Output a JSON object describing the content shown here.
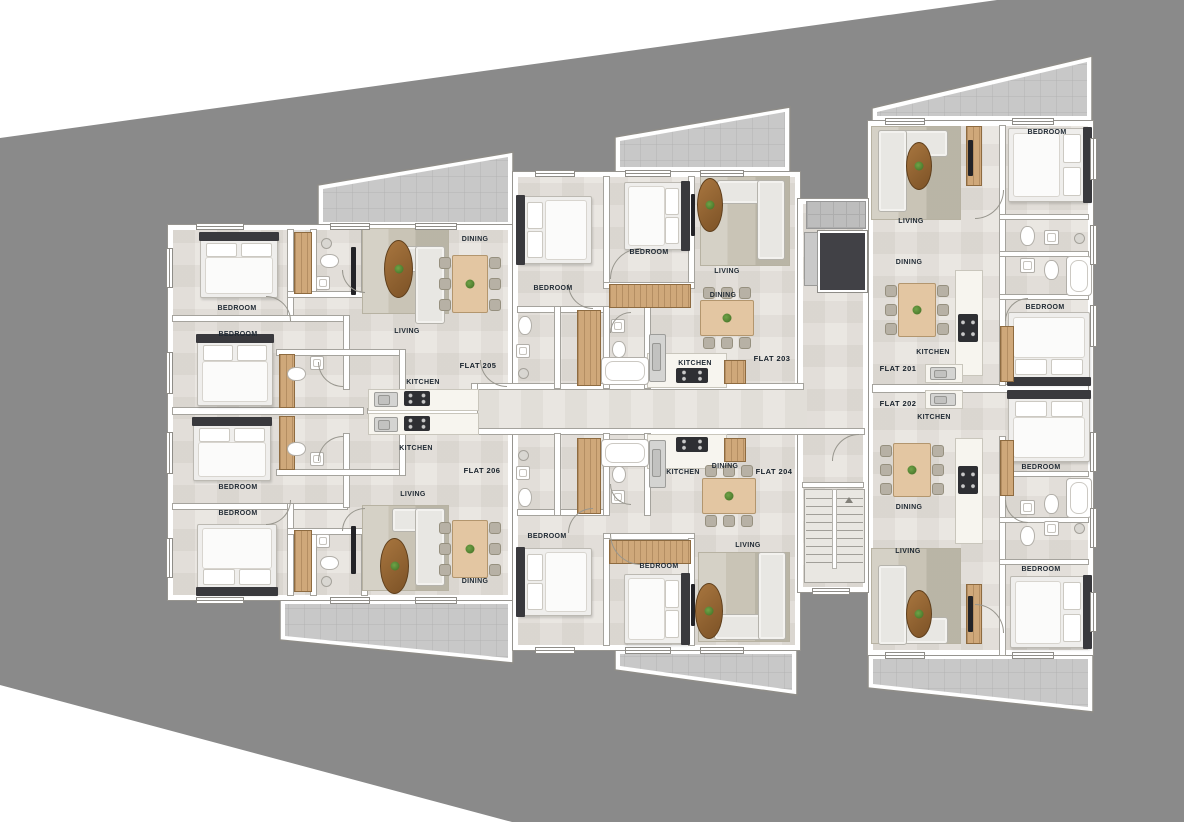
{
  "plan": {
    "kind": "residential floor plan",
    "flats_count": 6
  },
  "flats": {
    "f201": {
      "name": "FLAT 201",
      "rooms": {
        "living": "LIVING",
        "dining": "DINING",
        "kitchen": "KITCHEN",
        "bedroom_a": "BEDROOM",
        "bedroom_b": "BEDROOM"
      }
    },
    "f202": {
      "name": "FLAT 202",
      "rooms": {
        "living": "LIVING",
        "dining": "DINING",
        "kitchen": "KITCHEN",
        "bedroom_a": "BEDROOM",
        "bedroom_b": "BEDROOM"
      }
    },
    "f203": {
      "name": "FLAT 203",
      "rooms": {
        "living": "LIVING",
        "dining": "DINING",
        "kitchen": "KITCHEN",
        "bedroom_a": "BEDROOM",
        "bedroom_b": "BEDROOM"
      }
    },
    "f204": {
      "name": "FLAT 204",
      "rooms": {
        "living": "LIVING",
        "dining": "DINING",
        "kitchen": "KITCHEN",
        "bedroom_a": "BEDROOM",
        "bedroom_b": "BEDROOM"
      }
    },
    "f205": {
      "name": "FLAT 205",
      "rooms": {
        "living": "LIVING",
        "dining": "DINING",
        "kitchen": "KITCHEN",
        "bedroom_a": "BEDROOM",
        "bedroom_b": "BEDROOM"
      }
    },
    "f206": {
      "name": "FLAT 206",
      "rooms": {
        "living": "LIVING",
        "dining": "DINING",
        "kitchen": "KITCHEN",
        "bedroom_a": "BEDROOM",
        "bedroom_b": "BEDROOM"
      }
    }
  },
  "colors": {
    "site_background": "#8a8a8a",
    "paper": "#ffffff",
    "floor_tile": "#eae7e2",
    "balcony_tile": "#c8c8c8",
    "wall": "#ffffff",
    "wall_edge": "#96948f",
    "wood": "#cfa87a",
    "dining_table": "#e3c6a2",
    "sofa": "#e8e7e3",
    "rug": "#c9c4b6",
    "coffee_table": "#8a5a2d",
    "plant": "#4e7d2f",
    "stove": "#2e2f33",
    "elevator_shaft": "#414146",
    "label_text": "#1f2933"
  }
}
